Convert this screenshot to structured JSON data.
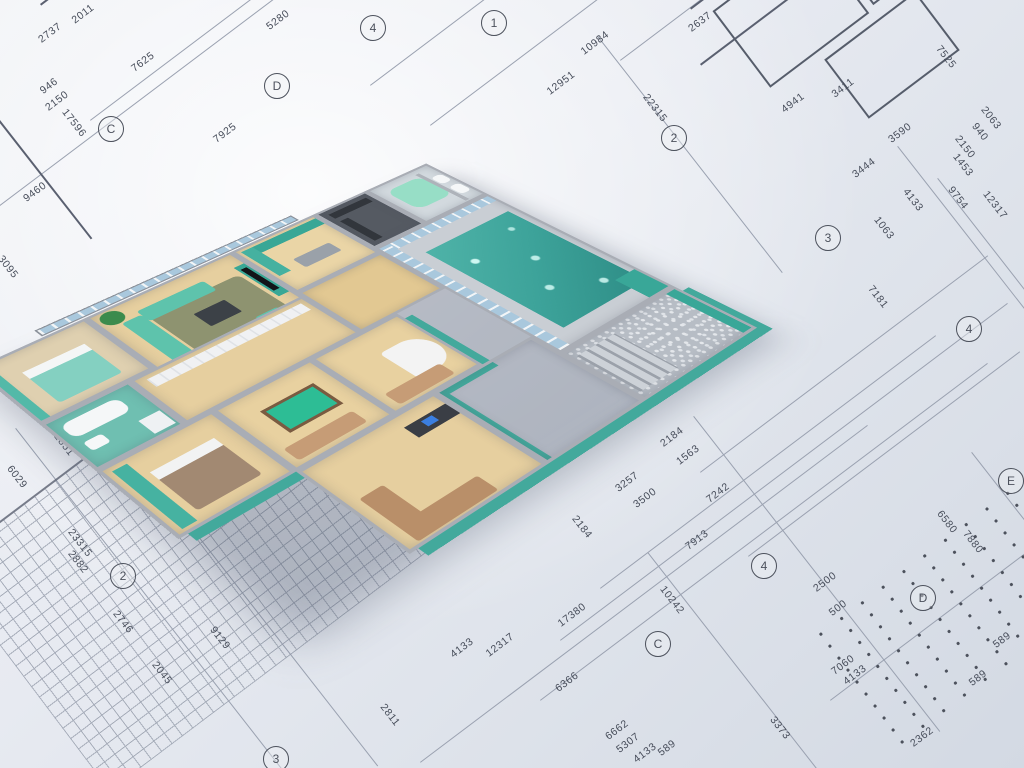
{
  "scene": {
    "type": "3d-floor-plan-render",
    "description": "Photorealistic 3D cutaway model of an apartment with indoor swimming pool, standing on architectural blueprint sheets with dimension lines"
  },
  "palette": {
    "blueprint_paper": "#e7eaf1",
    "blueprint_line": "#5a6070",
    "wall_grey": "#a9adb5",
    "accent_teal": "#43a99c",
    "sofa_mint": "#5ec3ac",
    "pool_water": "#3da39a",
    "wood_floor": "#e6cf9f",
    "tan_leather": "#c69c76",
    "glass_blue": "#a9c8dd"
  },
  "blueprint": {
    "dimensions": [
      {
        "t": "2011",
        "x": 83,
        "y": 14,
        "r": -37
      },
      {
        "t": "2737",
        "x": 50,
        "y": 33,
        "r": -37
      },
      {
        "t": "946",
        "x": 49,
        "y": 86,
        "r": -37
      },
      {
        "t": "2150",
        "x": 57,
        "y": 101,
        "r": -37
      },
      {
        "t": "7625",
        "x": 143,
        "y": 62,
        "r": -37
      },
      {
        "t": "17596",
        "x": 74,
        "y": 123,
        "r": 52
      },
      {
        "t": "7925",
        "x": 225,
        "y": 133,
        "r": -37
      },
      {
        "t": "5280",
        "x": 278,
        "y": 20,
        "r": -37
      },
      {
        "t": "9460",
        "x": 35,
        "y": 192,
        "r": -37
      },
      {
        "t": "3095",
        "x": 8,
        "y": 267,
        "r": 52
      },
      {
        "t": "12884",
        "x": 107,
        "y": 392,
        "r": 52
      },
      {
        "t": "12851",
        "x": 62,
        "y": 442,
        "r": 52
      },
      {
        "t": "6029",
        "x": 17,
        "y": 477,
        "r": 52
      },
      {
        "t": "23315",
        "x": 80,
        "y": 543,
        "r": 52
      },
      {
        "t": "2882",
        "x": 78,
        "y": 562,
        "r": 52
      },
      {
        "t": "2746",
        "x": 123,
        "y": 622,
        "r": 52
      },
      {
        "t": "2045",
        "x": 162,
        "y": 673,
        "r": 52
      },
      {
        "t": "9129",
        "x": 220,
        "y": 638,
        "r": 52
      },
      {
        "t": "2811",
        "x": 390,
        "y": 715,
        "r": 52
      },
      {
        "t": "4133",
        "x": 462,
        "y": 648,
        "r": -37
      },
      {
        "t": "12317",
        "x": 500,
        "y": 645,
        "r": -37
      },
      {
        "t": "17380",
        "x": 572,
        "y": 615,
        "r": -37
      },
      {
        "t": "6366",
        "x": 567,
        "y": 682,
        "r": -37
      },
      {
        "t": "6662",
        "x": 617,
        "y": 730,
        "r": -37
      },
      {
        "t": "5307",
        "x": 628,
        "y": 743,
        "r": -37
      },
      {
        "t": "4133",
        "x": 645,
        "y": 753,
        "r": -37
      },
      {
        "t": "589",
        "x": 667,
        "y": 748,
        "r": -37
      },
      {
        "t": "10242",
        "x": 672,
        "y": 600,
        "r": 52
      },
      {
        "t": "2184",
        "x": 672,
        "y": 437,
        "r": -37
      },
      {
        "t": "1563",
        "x": 688,
        "y": 455,
        "r": -37
      },
      {
        "t": "3257",
        "x": 627,
        "y": 482,
        "r": -37
      },
      {
        "t": "3500",
        "x": 645,
        "y": 498,
        "r": -37
      },
      {
        "t": "7242",
        "x": 718,
        "y": 493,
        "r": -37
      },
      {
        "t": "2184",
        "x": 582,
        "y": 527,
        "r": 52
      },
      {
        "t": "7913",
        "x": 697,
        "y": 540,
        "r": -37
      },
      {
        "t": "2500",
        "x": 825,
        "y": 582,
        "r": -37
      },
      {
        "t": "500",
        "x": 838,
        "y": 608,
        "r": -37
      },
      {
        "t": "7060",
        "x": 843,
        "y": 665,
        "r": -37
      },
      {
        "t": "4133",
        "x": 855,
        "y": 675,
        "r": -37
      },
      {
        "t": "3373",
        "x": 780,
        "y": 728,
        "r": 52
      },
      {
        "t": "2362",
        "x": 922,
        "y": 737,
        "r": -37
      },
      {
        "t": "589",
        "x": 1002,
        "y": 640,
        "r": -37
      },
      {
        "t": "589",
        "x": 978,
        "y": 678,
        "r": -37
      },
      {
        "t": "7181",
        "x": 878,
        "y": 297,
        "r": 52
      },
      {
        "t": "1063",
        "x": 884,
        "y": 228,
        "r": 52
      },
      {
        "t": "4133",
        "x": 913,
        "y": 200,
        "r": 52
      },
      {
        "t": "9754",
        "x": 958,
        "y": 198,
        "r": 52
      },
      {
        "t": "12317",
        "x": 995,
        "y": 205,
        "r": 52
      },
      {
        "t": "6580",
        "x": 947,
        "y": 522,
        "r": 52
      },
      {
        "t": "7880",
        "x": 973,
        "y": 542,
        "r": 52
      },
      {
        "t": "10984",
        "x": 595,
        "y": 43,
        "r": -37
      },
      {
        "t": "12951",
        "x": 561,
        "y": 83,
        "r": -37
      },
      {
        "t": "22315",
        "x": 655,
        "y": 108,
        "r": 52
      },
      {
        "t": "2637",
        "x": 700,
        "y": 22,
        "r": -37
      },
      {
        "t": "4941",
        "x": 793,
        "y": 103,
        "r": -37
      },
      {
        "t": "3411",
        "x": 843,
        "y": 88,
        "r": -37
      },
      {
        "t": "3590",
        "x": 900,
        "y": 133,
        "r": -37
      },
      {
        "t": "3444",
        "x": 864,
        "y": 168,
        "r": -37
      },
      {
        "t": "1453",
        "x": 963,
        "y": 165,
        "r": 52
      },
      {
        "t": "940",
        "x": 980,
        "y": 132,
        "r": 52
      },
      {
        "t": "2063",
        "x": 991,
        "y": 118,
        "r": 52
      },
      {
        "t": "2150",
        "x": 965,
        "y": 147,
        "r": 52
      },
      {
        "t": "7525",
        "x": 946,
        "y": 57,
        "r": 52
      }
    ],
    "grid_bubbles": [
      {
        "t": "C",
        "x": 110,
        "y": 128
      },
      {
        "t": "D",
        "x": 276,
        "y": 85
      },
      {
        "t": "4",
        "x": 372,
        "y": 27
      },
      {
        "t": "1",
        "x": 493,
        "y": 22
      },
      {
        "t": "2",
        "x": 673,
        "y": 137
      },
      {
        "t": "3",
        "x": 827,
        "y": 237
      },
      {
        "t": "4",
        "x": 968,
        "y": 328
      },
      {
        "t": "E",
        "x": 1010,
        "y": 480
      },
      {
        "t": "D",
        "x": 922,
        "y": 597
      },
      {
        "t": "C",
        "x": 657,
        "y": 643
      },
      {
        "t": "4",
        "x": 763,
        "y": 565
      },
      {
        "t": "2",
        "x": 122,
        "y": 575
      },
      {
        "t": "3",
        "x": 275,
        "y": 758
      }
    ]
  },
  "house": {
    "balcony": {
      "name": "balcony-glass-railing",
      "rect": [
        80,
        -16,
        340,
        14
      ]
    },
    "rooms": [
      {
        "name": "room-bedroom-1",
        "floor": "#dfd0b0",
        "rect": [
          0,
          0,
          130,
          120
        ],
        "items": [
          {
            "name": "curtain",
            "rect": [
              0,
              0,
              10,
              112
            ],
            "color": "#53b9a8"
          },
          {
            "name": "bed-teal",
            "rect": [
              28,
              34,
              72,
              66
            ],
            "color": "#84d0c1",
            "radius": "4px"
          },
          {
            "name": "bed-pillows",
            "rect": [
              28,
              34,
              72,
              14
            ],
            "color": "#f4f6f6"
          }
        ]
      },
      {
        "name": "room-bathroom-1",
        "floor": "#6fbfb1",
        "rect": [
          0,
          120,
          100,
          92
        ],
        "items": [
          {
            "name": "bathtub",
            "rect": [
              8,
              10,
              64,
              26
            ],
            "color": "#f5f7f8",
            "radius": "10px"
          },
          {
            "name": "sink",
            "rect": [
              10,
              46,
              20,
              16
            ],
            "color": "#f5f7f8",
            "radius": "4px"
          },
          {
            "name": "washing-machine",
            "rect": [
              66,
              54,
              24,
              26
            ],
            "color": "#eef1f3"
          }
        ]
      },
      {
        "name": "room-living",
        "floor": "#e6cf9f",
        "rect": [
          130,
          0,
          190,
          152
        ],
        "items": [
          {
            "name": "area-rug",
            "rect": [
              45,
              38,
              118,
              92
            ],
            "color": "#8e9370",
            "radius": "8px"
          },
          {
            "name": "sofa-long",
            "rect": [
              18,
              30,
              24,
              96
            ],
            "color": "#5ec3ac",
            "radius": "4px"
          },
          {
            "name": "sofa-short",
            "rect": [
              42,
              22,
              86,
              24
            ],
            "color": "#5ec3ac",
            "radius": "4px"
          },
          {
            "name": "armchair",
            "rect": [
              124,
              114,
              30,
              26
            ],
            "color": "#5ec3ac",
            "radius": "4px"
          },
          {
            "name": "coffee-table",
            "rect": [
              82,
              66,
              40,
              30
            ],
            "color": "#3c4147",
            "radius": "2px"
          },
          {
            "name": "media-wall",
            "rect": [
              168,
              24,
              14,
              76
            ],
            "color": "#39a796"
          },
          {
            "name": "tv-screen",
            "rect": [
              171,
              32,
              8,
              56
            ],
            "color": "#121418"
          },
          {
            "name": "potted-plant",
            "rect": [
              4,
              2,
              26,
              26
            ],
            "color": "#3c8b4d",
            "radius": "50%"
          }
        ]
      },
      {
        "name": "room-kitchen",
        "floor": "#ead5a6",
        "rect": [
          320,
          0,
          120,
          112
        ],
        "items": [
          {
            "name": "cabinets-top",
            "rect": [
              4,
              4,
              108,
              16
            ],
            "color": "#39a796"
          },
          {
            "name": "cabinets-left",
            "rect": [
              4,
              4,
              16,
              66
            ],
            "color": "#45b1a0"
          },
          {
            "name": "kitchen-island",
            "rect": [
              36,
              54,
              52,
              22
            ],
            "color": "#9aa1a9",
            "radius": "3px"
          }
        ]
      },
      {
        "name": "room-walk-in-closet",
        "floor": "#555a62",
        "rect": [
          440,
          0,
          80,
          102
        ],
        "items": [
          {
            "name": "closet-shelves",
            "rect": [
              8,
              8,
              58,
              12
            ],
            "color": "#32363c"
          },
          {
            "name": "closet-shelves-2",
            "rect": [
              8,
              28,
              12,
              58
            ],
            "color": "#32363c"
          }
        ]
      },
      {
        "name": "room-bathroom-jacuzzi",
        "floor": "#d2d9de",
        "rect": [
          520,
          0,
          100,
          102
        ],
        "items": [
          {
            "name": "jacuzzi-tub",
            "rect": [
              12,
              14,
              56,
              56
            ],
            "color": "#97dec6",
            "radius": "14px"
          },
          {
            "name": "partition-wall",
            "rect": [
              66,
              8,
              6,
              84
            ],
            "color": "#aeb3ba"
          },
          {
            "name": "toilet",
            "rect": [
              74,
              56,
              16,
              22
            ],
            "color": "#f5f7f8",
            "radius": "6px"
          },
          {
            "name": "bidet",
            "rect": [
              74,
              26,
              16,
              20
            ],
            "color": "#f5f7f8",
            "radius": "6px"
          }
        ]
      },
      {
        "name": "room-hallway",
        "floor": "#e6cf9f",
        "rect": [
          100,
          120,
          220,
          92
        ],
        "items": [
          {
            "name": "wardrobe-doors",
            "rect": [
              10,
              6,
              196,
              16
            ],
            "color": "wardrobe"
          }
        ]
      },
      {
        "name": "room-corridor",
        "floor": "#e2c892",
        "rect": [
          320,
          112,
          120,
          100
        ],
        "items": []
      },
      {
        "name": "room-bedroom-2",
        "floor": "#e6cf9f",
        "rect": [
          0,
          212,
          130,
          122
        ],
        "edge": true,
        "items": [
          {
            "name": "shelf-wall-teal",
            "rect": [
              6,
              6,
              16,
              104
            ],
            "color": "#46b2a1"
          },
          {
            "name": "bed-brown",
            "rect": [
              30,
              30,
              72,
              70
            ],
            "color": "#a28972",
            "radius": "4px"
          },
          {
            "name": "bed-pillows",
            "rect": [
              30,
              30,
              72,
              14
            ],
            "color": "#f2f3f3"
          }
        ]
      },
      {
        "name": "room-billiard",
        "floor": "#e8d1a0",
        "rect": [
          130,
          212,
          122,
          122
        ],
        "items": [
          {
            "name": "billiard-table",
            "rect": [
              28,
              28,
              66,
              44
            ],
            "color": "#2dbd95",
            "border": "4px solid #7a5b41"
          },
          {
            "name": "sofa-tan",
            "rect": [
              8,
              86,
              84,
              22
            ],
            "color": "#c69c76",
            "radius": "4px"
          }
        ]
      },
      {
        "name": "room-music",
        "floor": "#e8d1a0",
        "rect": [
          252,
          212,
          118,
          122
        ],
        "edge": true,
        "items": [
          {
            "name": "grand-piano",
            "rect": [
              52,
              36,
              54,
              56
            ],
            "color": "#f3f3f3",
            "radius": "6px 50% 50% 6px"
          },
          {
            "name": "sofa-tan",
            "rect": [
              10,
              88,
              74,
              22
            ],
            "color": "#c69c76",
            "radius": "4px"
          }
        ]
      },
      {
        "name": "room-office",
        "floor": "#e6cf9f",
        "rect": [
          130,
          334,
          172,
          146
        ],
        "edge": true,
        "items": [
          {
            "name": "sectional-sofa-a",
            "rect": [
              12,
              62,
              28,
              74
            ],
            "color": "#b98f69",
            "radius": "3px"
          },
          {
            "name": "sectional-sofa-b",
            "rect": [
              12,
              110,
              98,
              26
            ],
            "color": "#b98f69",
            "radius": "3px"
          },
          {
            "name": "desk",
            "rect": [
              110,
              16,
              54,
              20
            ],
            "color": "#3a3e45"
          },
          {
            "name": "computer-monitor",
            "rect": [
              128,
              20,
              14,
              10
            ],
            "color": "#3b7fe0"
          }
        ]
      },
      {
        "name": "terrace-south",
        "floor": "mosaic",
        "rect": [
          302,
          334,
          138,
          146
        ],
        "edge": true,
        "items": []
      },
      {
        "name": "room-pool-hall",
        "floor": "#c9ced4",
        "rect": [
          440,
          102,
          180,
          272
        ],
        "items": [
          {
            "name": "glass-wall-north",
            "rect": [
              0,
              0,
              172,
              14
            ],
            "color": "glassH"
          },
          {
            "name": "glass-wall-west",
            "rect": [
              0,
              0,
              14,
              264
            ],
            "color": "glassV"
          },
          {
            "name": "pool-water",
            "rect": [
              32,
              40,
              132,
              200
            ],
            "color": "water"
          },
          {
            "name": "pool-platform-teal",
            "rect": [
              140,
              218,
              32,
              46
            ],
            "color": "#39a798"
          }
        ]
      },
      {
        "name": "terrace-pool",
        "floor": "stone",
        "rect": [
          440,
          374,
          180,
          106
        ],
        "edge": true,
        "items": [
          {
            "name": "terrace-steps",
            "rect": [
              4,
              10,
              58,
              80
            ],
            "color": "steps"
          },
          {
            "name": "parapet-teal",
            "rect": [
              158,
              0,
              14,
              98
            ],
            "color": "#39a798"
          }
        ]
      }
    ]
  }
}
